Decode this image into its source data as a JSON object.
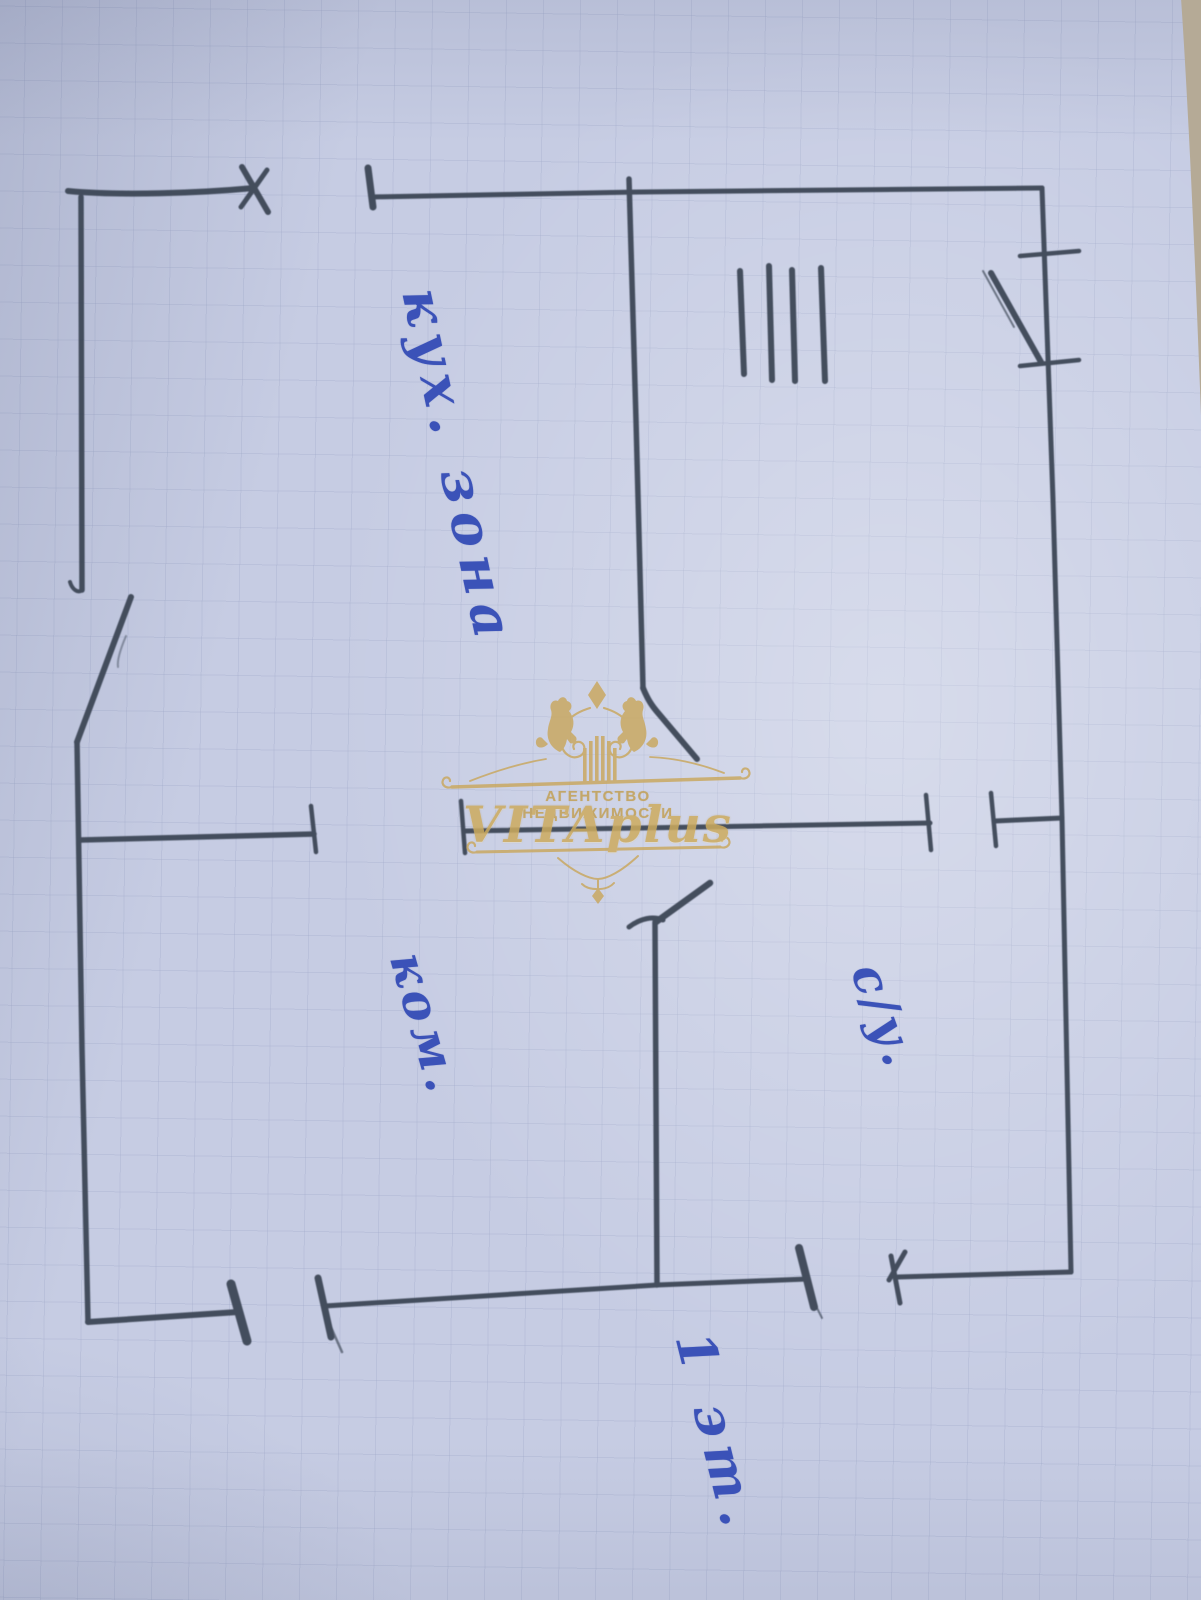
{
  "plan_labels": {
    "kitchen_zone": "кух. зона",
    "room": "ком.",
    "bathroom": "с/у.",
    "floor": "1 эт."
  },
  "watermark": {
    "agency": "АГЕНТСТВО НЕДВИЖИМОСТИ",
    "brand": "VITAplus"
  },
  "colors": {
    "paper": "#c6cce3",
    "grid_line": "#7e8bb2",
    "pencil": "#3c4656",
    "pen_ink": "#3b52b8",
    "watermark_gold": "#c9a65a",
    "table_background": "#b5aa96"
  }
}
